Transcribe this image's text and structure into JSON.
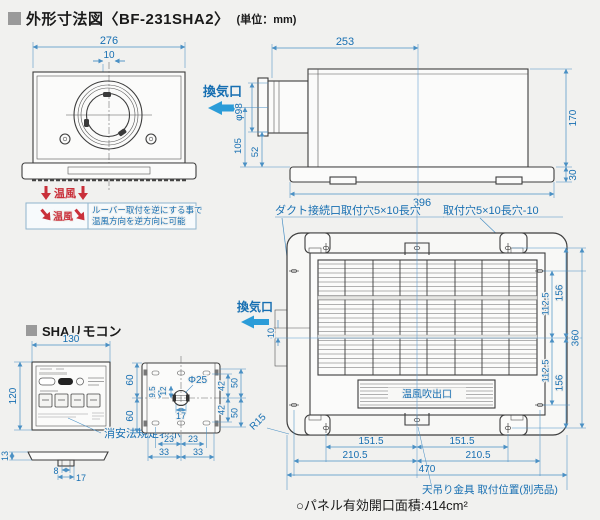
{
  "title": {
    "text": "外形寸法図〈BF-231SHA2〉",
    "unit": "(単位：mm)"
  },
  "colors": {
    "bg": "#f1f1ef",
    "line": "#3d3d3d",
    "dim_blue": "#176fb2",
    "arrow_blue": "#2b9cd8",
    "red": "#c9303a"
  },
  "front": {
    "dim_width": "276",
    "dim_offset": "10",
    "warm1": "温風",
    "warm2": "温風",
    "note1": "ルーバー取付を逆にする事で",
    "note2": "温風方向を逆方向に可能"
  },
  "side": {
    "vent": "換気口",
    "d253": "253",
    "d98": "φ98",
    "d105": "105",
    "d52": "52",
    "d170": "170",
    "d30": "30",
    "d396": "396"
  },
  "remote": {
    "title": "SHAリモコン",
    "d130": "130",
    "d120": "120",
    "d60a": "60",
    "d60b": "60",
    "law": "消安法規定表示",
    "d13": "13",
    "d8": "8",
    "d17": "17"
  },
  "plate": {
    "d25": "Φ25",
    "d95": "9.5",
    "d12": "12",
    "d17": "17",
    "d23a": "23",
    "d23b": "23",
    "d33a": "33",
    "d33b": "33",
    "d42a": "42",
    "d42b": "42",
    "d50a": "50",
    "d50b": "50"
  },
  "bottom": {
    "label_duct": "ダクト接続口取付穴5×10長穴",
    "label_mount": "取付穴5×10長穴-10",
    "vent": "換気口",
    "d10": "10",
    "outlet": "温風吹出口",
    "r15": "R15",
    "d151a": "151.5",
    "d151b": "151.5",
    "d210a": "210.5",
    "d210b": "210.5",
    "d470": "470",
    "d156a": "156",
    "d156b": "156",
    "d112a": "112.5",
    "d112b": "112.5",
    "d360": "360",
    "bracket": "天吊り金具 取付位置(別売品)"
  },
  "footer": {
    "note": "○パネル有効開口面積:414cm²"
  }
}
